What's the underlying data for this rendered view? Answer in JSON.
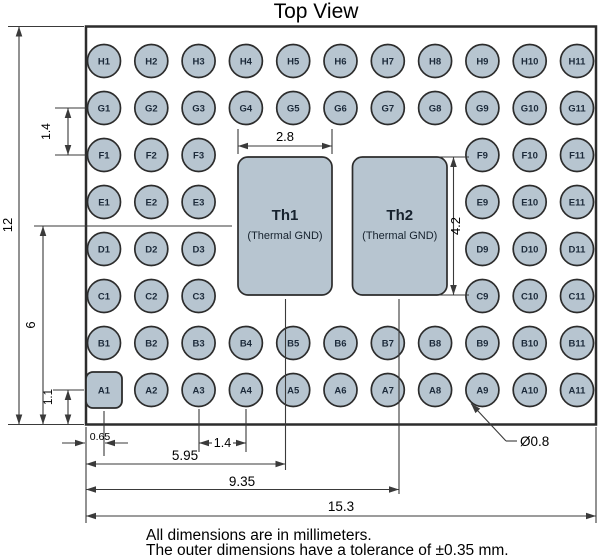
{
  "title": "Top View",
  "notes": [
    "All dimensions are in millimeters.",
    "The outer dimensions have a tolerance of ±0.35 mm."
  ],
  "grid": {
    "rows": [
      {
        "letter": "H",
        "pins": [
          "H1",
          "H2",
          "H3",
          "H4",
          "H5",
          "H6",
          "H7",
          "H8",
          "H9",
          "H10",
          "H11"
        ]
      },
      {
        "letter": "G",
        "pins": [
          "G1",
          "G2",
          "G3",
          "G4",
          "G5",
          "G6",
          "G7",
          "G8",
          "G9",
          "G10",
          "G11"
        ]
      },
      {
        "letter": "F",
        "pins": [
          "F1",
          "F2",
          "F3",
          "F9",
          "F10",
          "F11"
        ]
      },
      {
        "letter": "E",
        "pins": [
          "E1",
          "E2",
          "E3",
          "E9",
          "E10",
          "E11"
        ]
      },
      {
        "letter": "D",
        "pins": [
          "D1",
          "D2",
          "D3",
          "D9",
          "D10",
          "D11"
        ]
      },
      {
        "letter": "C",
        "pins": [
          "C1",
          "C2",
          "C3",
          "C9",
          "C10",
          "C11"
        ]
      },
      {
        "letter": "B",
        "pins": [
          "B1",
          "B2",
          "B3",
          "B4",
          "B5",
          "B6",
          "B7",
          "B8",
          "B9",
          "B10",
          "B11"
        ]
      },
      {
        "letter": "A",
        "pins": [
          "A1",
          "A2",
          "A3",
          "A4",
          "A5",
          "A6",
          "A7",
          "A8",
          "A9",
          "A10",
          "A11"
        ]
      }
    ],
    "square_pin": "A1"
  },
  "thermal_pads": [
    {
      "name": "Th1",
      "sublabel": "(Thermal GND)"
    },
    {
      "name": "Th2",
      "sublabel": "(Thermal GND)"
    }
  ],
  "dimensions": {
    "overall_height": "12",
    "center_to_bottom": "6",
    "row_pitch": "1.4",
    "a_row_to_edge": "1.1",
    "pad_width": "2.8",
    "pad_height": "4.2",
    "edge_to_col1": "0.65",
    "col_pitch": "1.4",
    "edge_to_th1_center": "5.95",
    "edge_to_th2_center": "9.35",
    "overall_width": "15.3",
    "pin_diameter": "Ø0.8"
  },
  "colors": {
    "background": "#ffffff",
    "pad_fill": "#b7c5d0",
    "shape_outline": "#2c2c2c",
    "dimension_line": "#3a3a3a",
    "pin_text": "#1c2a3a",
    "text": "#000000"
  }
}
